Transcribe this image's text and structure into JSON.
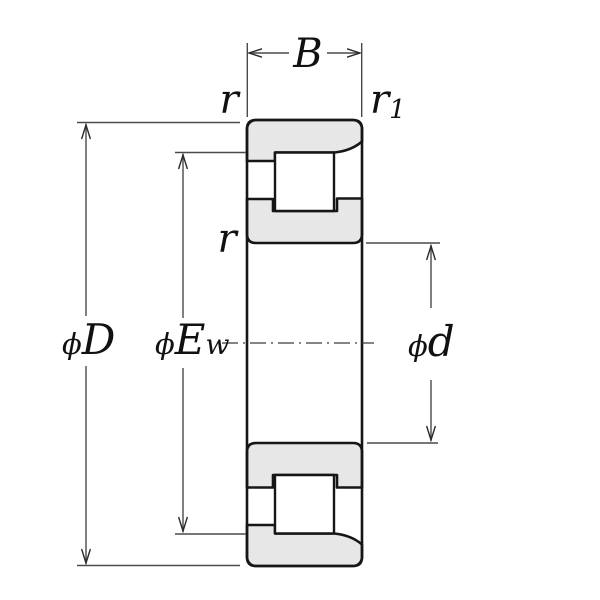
{
  "labels": {
    "width": "B",
    "chamfer_r": "r",
    "chamfer_r1": {
      "base": "r",
      "sub": "1"
    },
    "outer_diameter": {
      "phi": "ϕ",
      "letter": "D"
    },
    "raceway_diameter": {
      "phi": "ϕ",
      "letter": "E",
      "sub": "w"
    },
    "inner_chamfer": "r",
    "bore_diameter": {
      "phi": "ϕ",
      "letter": "d"
    }
  },
  "colors": {
    "background": "#ffffff",
    "ring_fill": "#e7e7e7",
    "roller_fill": "#ffffff",
    "outline": "#161616",
    "dimension_line": "#4a4a4a"
  }
}
